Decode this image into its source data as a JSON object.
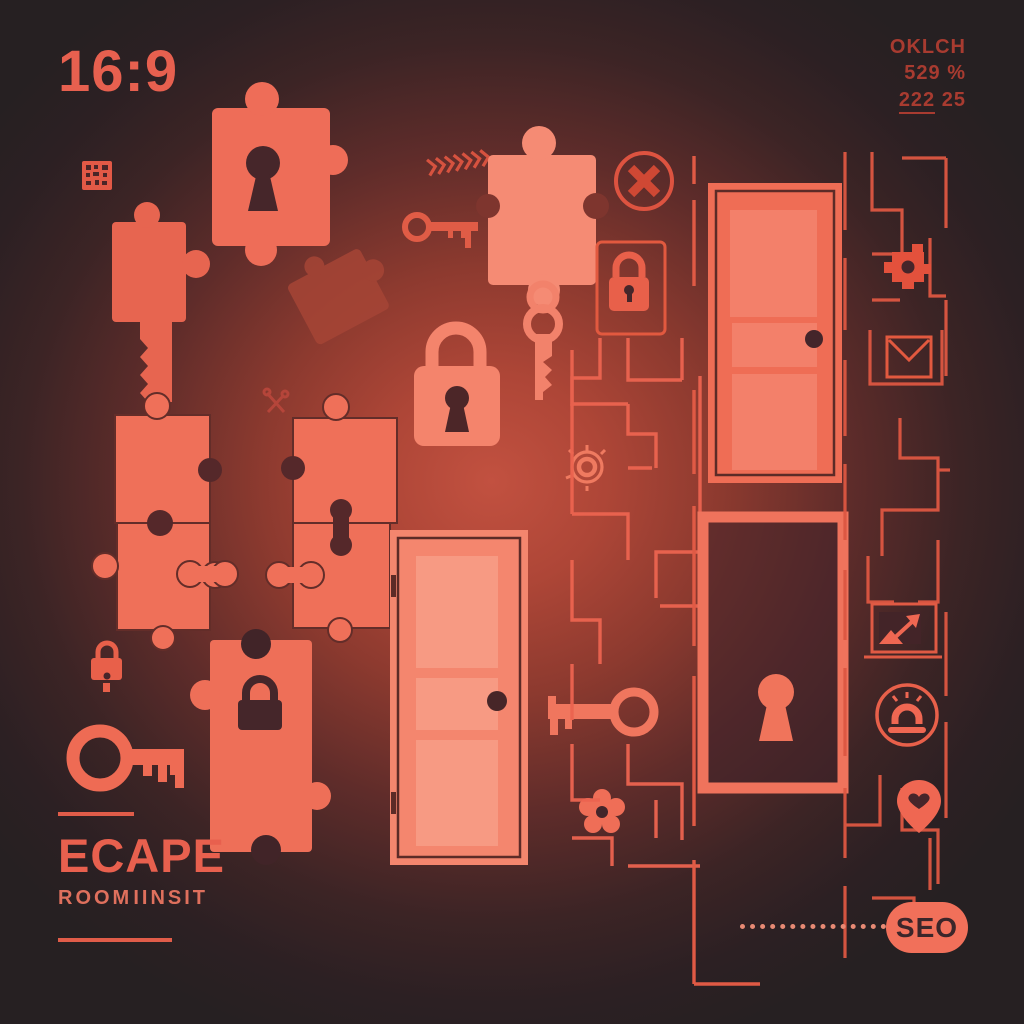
{
  "canvas": {
    "width": 1024,
    "height": 1024,
    "theme": "escape-room illustration"
  },
  "colors": {
    "coral": "#f0705a",
    "coral_bright": "#f58a72",
    "coral_dim": "#c24a3a",
    "dark_detail": "#43252a",
    "background_center_glow": "#c25140",
    "background_edge": "#262022",
    "dim_text": "#a83b30",
    "badge_background": "#f1705a",
    "badge_text": "#3b262a"
  },
  "header": {
    "aspect_ratio": "16:9",
    "color_spec_line1": "OKLCH",
    "color_spec_line2": "529 %",
    "color_spec_line3a": "222",
    "color_spec_line3b": "25"
  },
  "title_block": {
    "title": "ECAPE",
    "subtitle_word1": "ROOM",
    "subtitle_word2": "IINSIT"
  },
  "footer": {
    "badge": "SEO"
  },
  "icons": [
    "qr-code-icon",
    "puzzle-piece-keyhole",
    "puzzle-piece-tall",
    "puzzle-piece-rotated",
    "crossed-keys-glyph",
    "puzzle-cluster",
    "padlock-small-icon",
    "key-large-icon",
    "puzzle-piece-lock",
    "chevron-arrows-icon",
    "key-small-icon",
    "puzzle-piece-top",
    "hanging-key-icon",
    "x-circle-icon",
    "lock-frame-icon",
    "padlock-large-icon",
    "door-center",
    "target-dial-icon",
    "key-left-icon",
    "gear-flower-icon",
    "door-upper-right",
    "door-keyhole-lower-right",
    "maze-center",
    "maze-right",
    "puzzle-cross-icon",
    "envelope-icon",
    "image-arrow-icon",
    "alarm-bell-icon",
    "location-pin-icon",
    "dotted-line",
    "seo-badge"
  ]
}
